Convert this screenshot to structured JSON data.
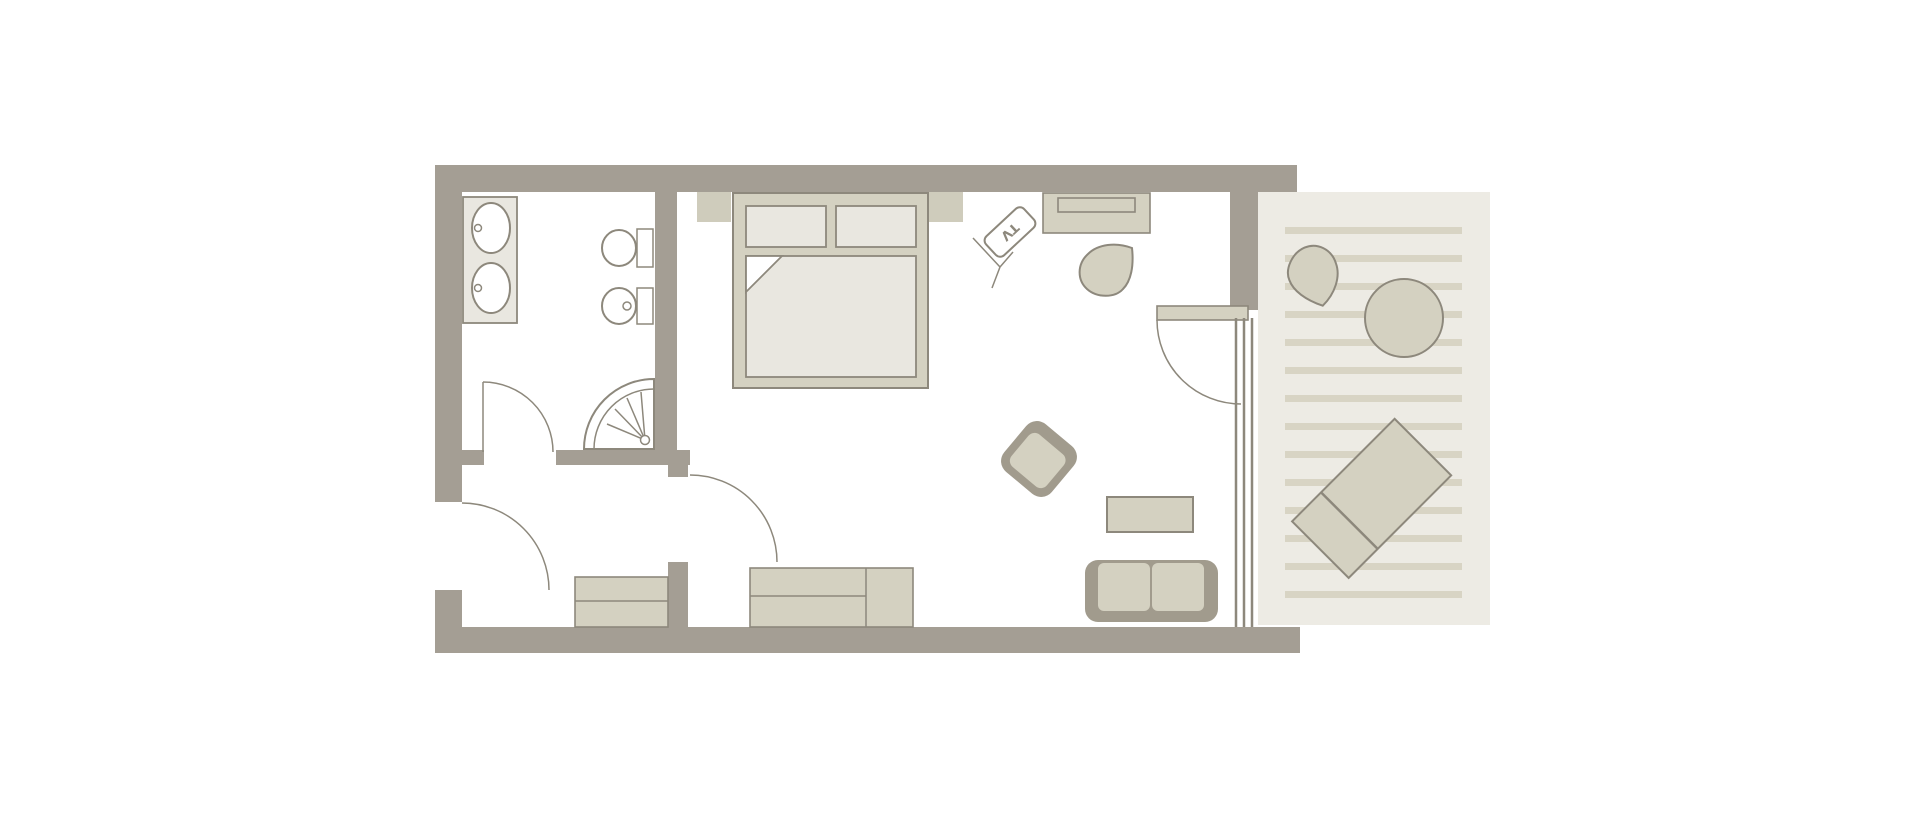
{
  "floorplan": {
    "type": "hotel-room-floor-plan",
    "tv_label": "TV",
    "rooms": {
      "bathroom": {
        "fixtures": [
          "double-sink-vanity",
          "toilet",
          "bidet",
          "corner-shower"
        ],
        "doors": [
          "bathroom-door"
        ]
      },
      "entry": {
        "furniture": [
          "luggage-bench"
        ],
        "doors": [
          "entrance-door",
          "interior-door"
        ]
      },
      "bedroom_living": {
        "furniture": [
          "double-bed",
          "pillow",
          "pillow",
          "nightstand-left",
          "nightstand-right",
          "tv-on-stand",
          "desk",
          "desk-chair",
          "armchair",
          "coffee-table",
          "two-seat-sofa",
          "sideboard"
        ],
        "doors": [
          "balcony-door",
          "sliding-glass-door"
        ]
      },
      "balcony": {
        "furniture": [
          "fan-chair",
          "round-table",
          "sun-lounger"
        ],
        "floor": "deck-stripes"
      }
    }
  },
  "colors": {
    "background": "#ffffff",
    "wall": "#a49e94",
    "outline": "#8d887c",
    "furniture": "#d4d1c1",
    "furniture_dark": "#a19b8d",
    "soft": "#e9e7e0",
    "fixture": "#ffffff",
    "nightstand": "#cfccbc",
    "balcony_bg": "#edebe4",
    "balcony_stripe": "#d8d4c4"
  }
}
